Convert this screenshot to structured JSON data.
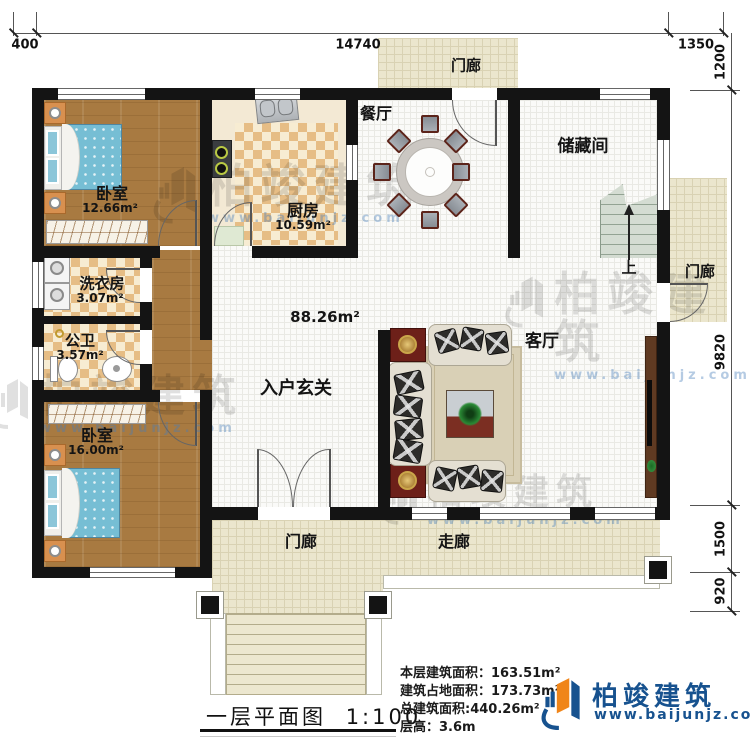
{
  "plan": {
    "title": "一层平面图",
    "scale": "1:100",
    "interior_area": "88.26m²",
    "rooms": {
      "bedroom1": {
        "name": "卧室",
        "area": "12.66m²"
      },
      "kitchen": {
        "name": "厨房",
        "area": "10.59m²"
      },
      "dining": {
        "name": "餐厅"
      },
      "storage": {
        "name": "储藏间"
      },
      "laundry": {
        "name": "洗衣房",
        "area": "3.07m²"
      },
      "bathroom": {
        "name": "公卫",
        "area": "3.57m²"
      },
      "bedroom2": {
        "name": "卧室",
        "area": "16.00m²"
      },
      "foyer": {
        "name": "入户玄关"
      },
      "living": {
        "name": "客厅"
      },
      "porch_top": {
        "name": "门廊"
      },
      "porch_right": {
        "name": "门廊"
      },
      "porch_bottom": {
        "name": "门廊"
      },
      "corridor": {
        "name": "走廊"
      },
      "stairs": {
        "up_label": "上"
      }
    },
    "dimensions": {
      "top_left": "400",
      "top_width": "14740",
      "top_right": "1350",
      "right_top": "1200",
      "right_main": "9820",
      "right_lower": "1500",
      "right_bottom": "920"
    }
  },
  "info_panel": {
    "floor_area_label": "本层建筑面积：",
    "floor_area_value": "163.51m²",
    "footprint_label": "建筑占地面积：",
    "footprint_value": "173.73m²",
    "total_area_label": "总建筑面积:",
    "total_area_value": "440.26m²",
    "height_label": "层高：",
    "height_value": "3.6m"
  },
  "brand": {
    "name": "柏竣建筑",
    "url": "www.baijunjz.com"
  },
  "watermark": {
    "name": "柏竣建筑",
    "url": "www.baijunjz.com"
  },
  "colors": {
    "wall": "#141414",
    "wood_floor": "#a87a41",
    "checker_tan": "#e6bd85",
    "tile_white": "#fafaf8",
    "porch_tile": "#ebe6cd",
    "bed_blue": "#76bed4",
    "brand_blue": "#17528f",
    "brand_orange": "#f08519"
  }
}
